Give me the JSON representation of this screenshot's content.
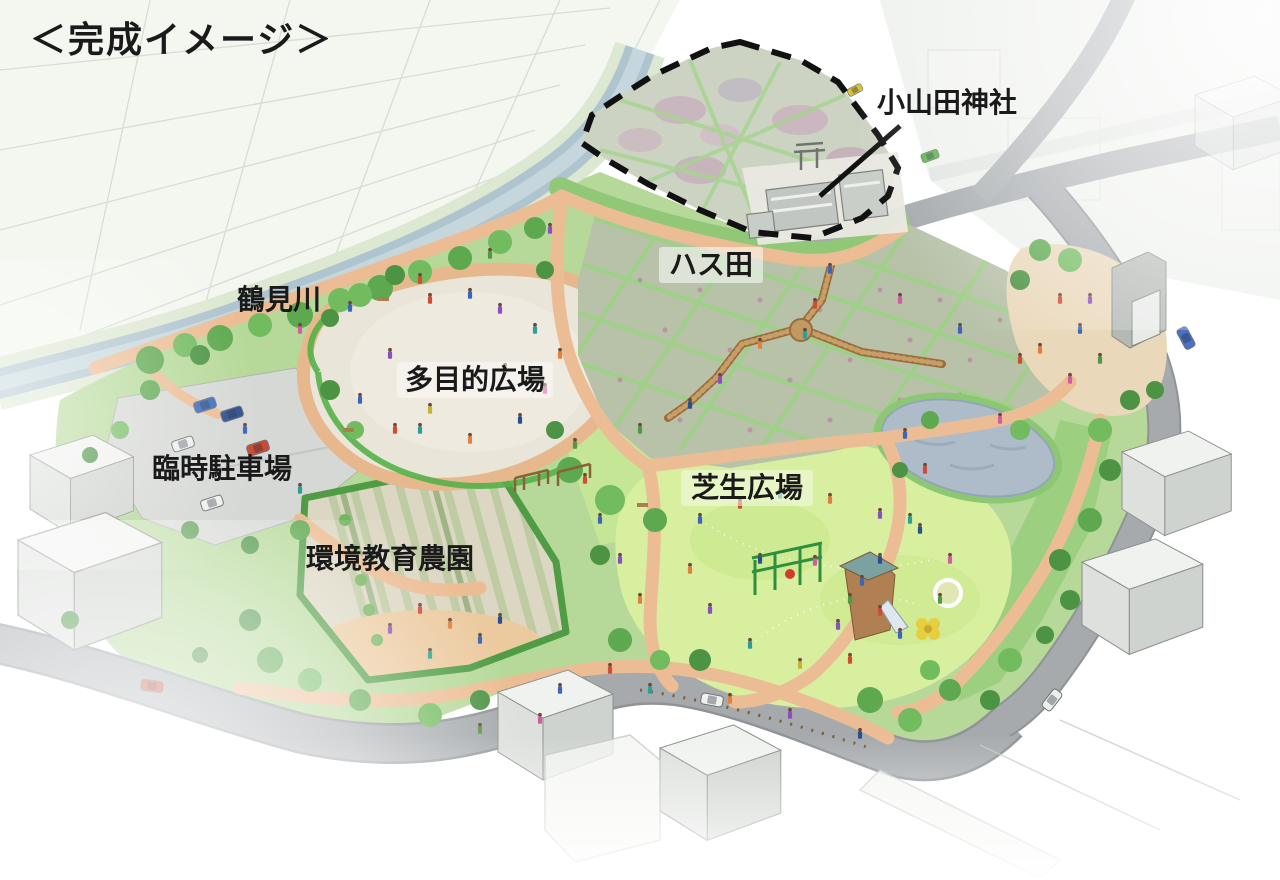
{
  "title": "＜完成イメージ＞",
  "labels": {
    "river": "鶴見川",
    "shrine": "小山田神社",
    "lotus_field": "ハス田",
    "multipurpose_plaza": "多目的広場",
    "temporary_parking": "臨時駐車場",
    "eco_education_farm": "環境教育農園",
    "lawn_plaza": "芝生広場"
  },
  "colors": {
    "label_text": "#1a1a1a",
    "river_water": "#aec4ce",
    "park_green": "#b6d999",
    "lawn_plaza_green": "#d8ef9f",
    "lotus_field_green": "#b7c2a9",
    "flower_field_pink": "#c79bbd",
    "path_tan": "#ecbd94",
    "plaza_ground": "#e9e5d9",
    "road_gray": "#a6aaad",
    "pond_blue": "#aebbc9",
    "boundary_dash": "#111111"
  }
}
